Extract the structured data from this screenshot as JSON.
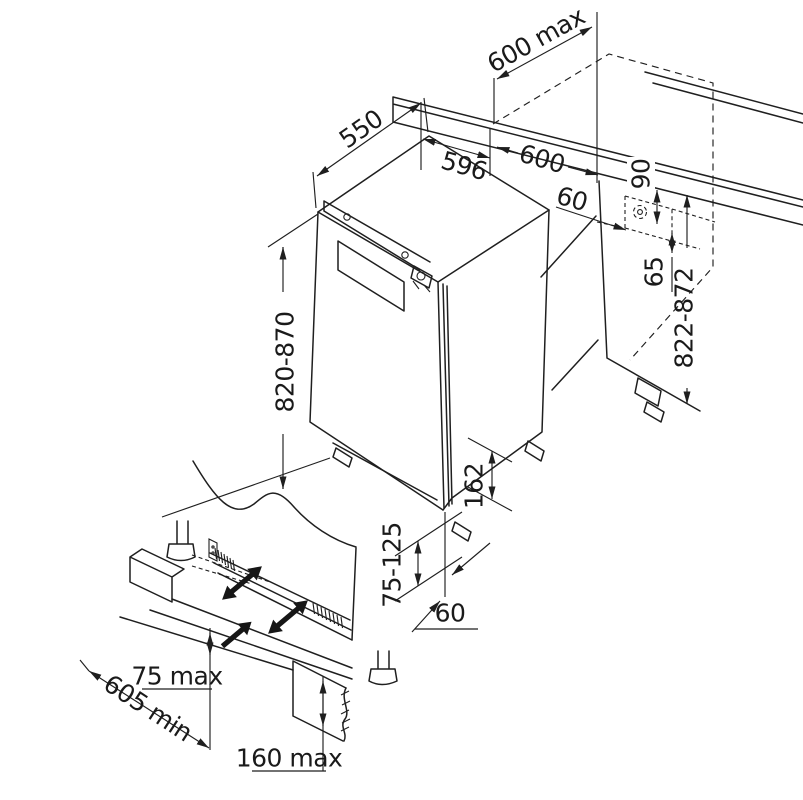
{
  "diagram": {
    "dims": {
      "niche_depth_max": "600 max",
      "appliance_depth": "550",
      "appliance_width": "596",
      "niche_width": "600",
      "worktop_front_offset": "60",
      "socket_zone_height": "90",
      "socket_zone_offset": "65",
      "niche_height_range": "822-872",
      "appliance_height_range": "820-870",
      "base_recess_height": "162",
      "plinth_height_range": "75-125",
      "door_plinth_clearance": "60",
      "plinth_overlap_max": "75 max",
      "plinth_board_min_length": "605 min",
      "plinth_cutout_max_height": "160 max"
    },
    "colors": {
      "line": "#1f1f1f",
      "background": "#ffffff"
    }
  }
}
